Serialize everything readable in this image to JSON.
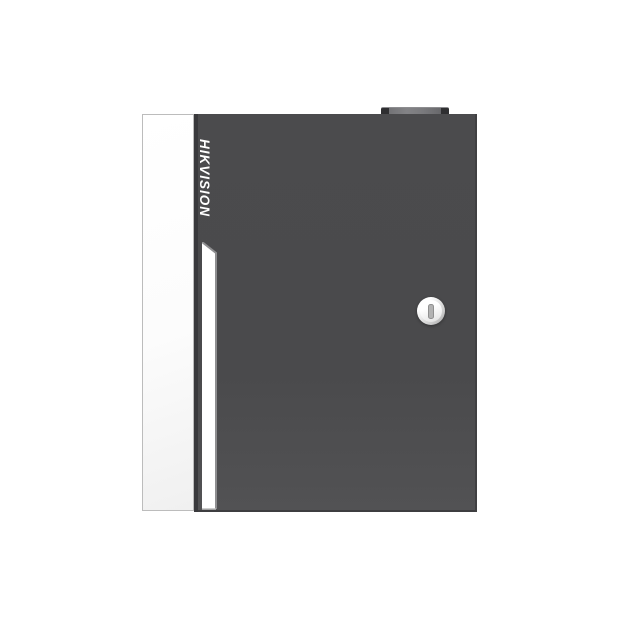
{
  "page": {
    "background": "#ffffff"
  },
  "product": {
    "brand_logo": "HIKVISION",
    "colors": {
      "door_body": "#4a4a4c",
      "door_left_edge": "#39393c",
      "door_outer_edge": "#3e3e40",
      "side_panel": "#fcfcfc",
      "side_panel_border": "#bcbcbc",
      "accent_stripe": "#ffffff",
      "stripe_shadow": "#8e8e90",
      "logo_text": "#ffffff",
      "hinge_body": "#7a7a7d",
      "hinge_caps": "#2f2f31",
      "lock_ring": "#9e9e9e",
      "lock_face": "#ffffff",
      "keyhole_slot": "#b2b2b2"
    },
    "icons": {
      "keyhole": "vertical keyhole slot"
    }
  }
}
